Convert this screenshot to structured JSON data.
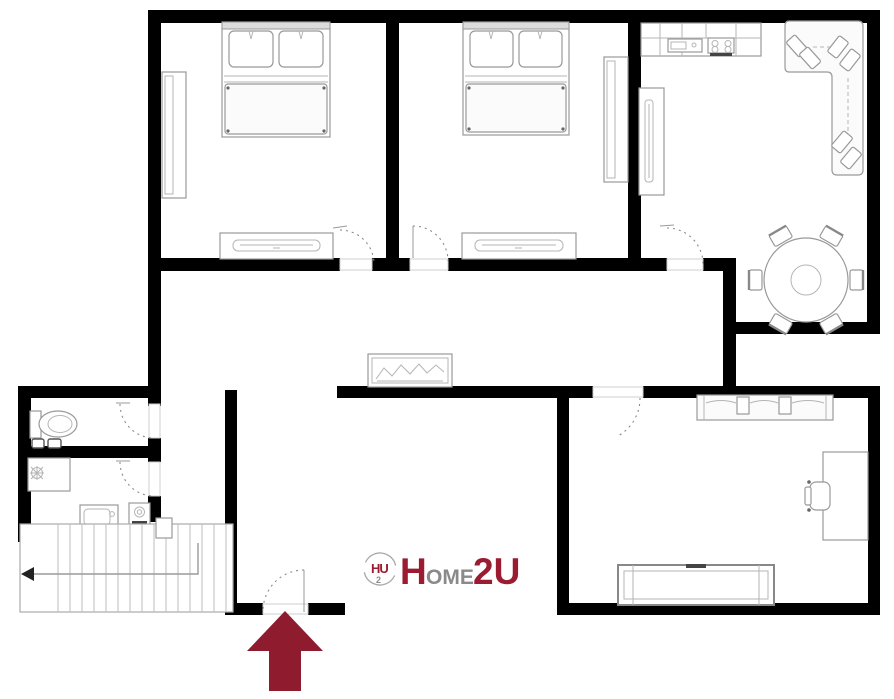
{
  "logo": {
    "icon_main": "HU",
    "icon_sub": "2",
    "word_h": "H",
    "word_ome": "OME",
    "word_2u": "2U"
  },
  "colors": {
    "walls": "#000000",
    "furniture_outline": "#999999",
    "brand_maroon": "#9B1C31",
    "brand_gray": "#8A8A8A",
    "entrance_arrow": "#8E1B2E"
  }
}
